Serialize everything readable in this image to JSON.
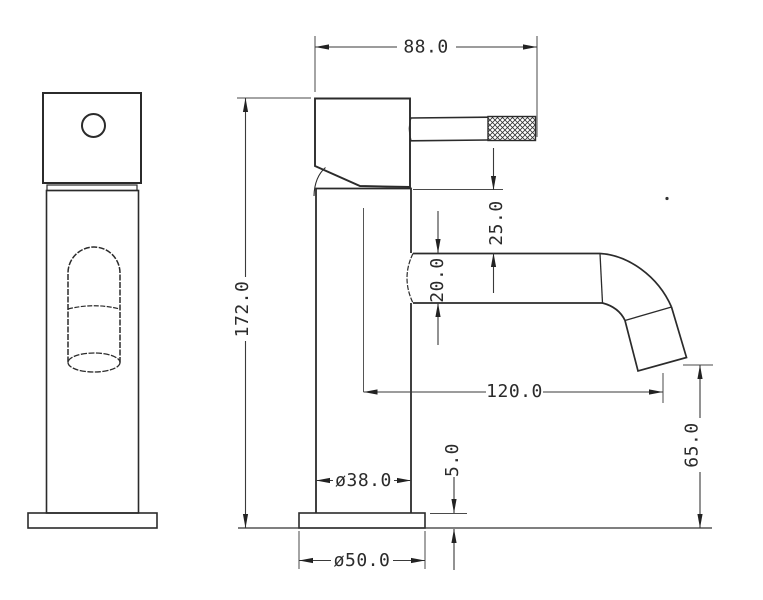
{
  "drawing": {
    "type": "technical-orthographic-drawing",
    "subject": "single-lever basin faucet, front and side views",
    "background_color": "#ffffff",
    "outline_color": "#2b2b2b",
    "dimension_color": "#3a3a3a",
    "dimensions": {
      "d88": {
        "label": "88.0",
        "orientation": "horizontal"
      },
      "d172": {
        "label": "172.0",
        "orientation": "vertical"
      },
      "d25": {
        "label": "25.0",
        "orientation": "vertical"
      },
      "d20": {
        "label": "20.0",
        "orientation": "vertical"
      },
      "d120": {
        "label": "120.0",
        "orientation": "horizontal"
      },
      "d65": {
        "label": "65.0",
        "orientation": "vertical"
      },
      "d38": {
        "label": "ø38.0",
        "orientation": "horizontal"
      },
      "d5": {
        "label": "5.0",
        "orientation": "vertical"
      },
      "d50": {
        "label": "ø50.0",
        "orientation": "horizontal"
      }
    }
  }
}
